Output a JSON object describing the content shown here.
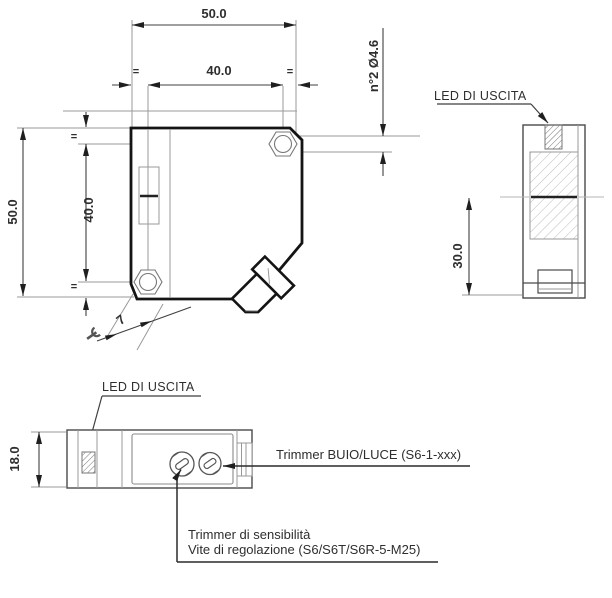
{
  "drawing": {
    "type": "technical-dimension-drawing",
    "views": [
      "main-side-view",
      "front-view",
      "top-view"
    ]
  },
  "colors": {
    "background": "#ffffff",
    "body_outline": "#141414",
    "medium_line": "#4a4a4a",
    "thin_line": "#9a9a9a",
    "dimension_line": "#3f3f3f",
    "text": "#2e2e2e"
  },
  "shared": {
    "equal_mark": "="
  },
  "main_view": {
    "dim_width_total": "50.0",
    "dim_width_holes": "40.0",
    "dim_height_total": "50.0",
    "dim_height_holes": "40.0",
    "holes_note": "n°2 Ø4.6",
    "wrench_size": "7"
  },
  "front_view": {
    "led_label": "LED DI USCITA",
    "dim_optical_axis_height": "30.0"
  },
  "bottom_view": {
    "led_label": "LED DI USCITA",
    "dim_height": "18.0",
    "trimmer_light_dark_label": "Trimmer BUIO/LUCE (S6-1-xxx)",
    "trimmer_sensitivity_label": "Trimmer di sensibilità",
    "adjustment_screw_label": "Vite di regolazione (S6/S6T/S6R-5-M25)"
  }
}
